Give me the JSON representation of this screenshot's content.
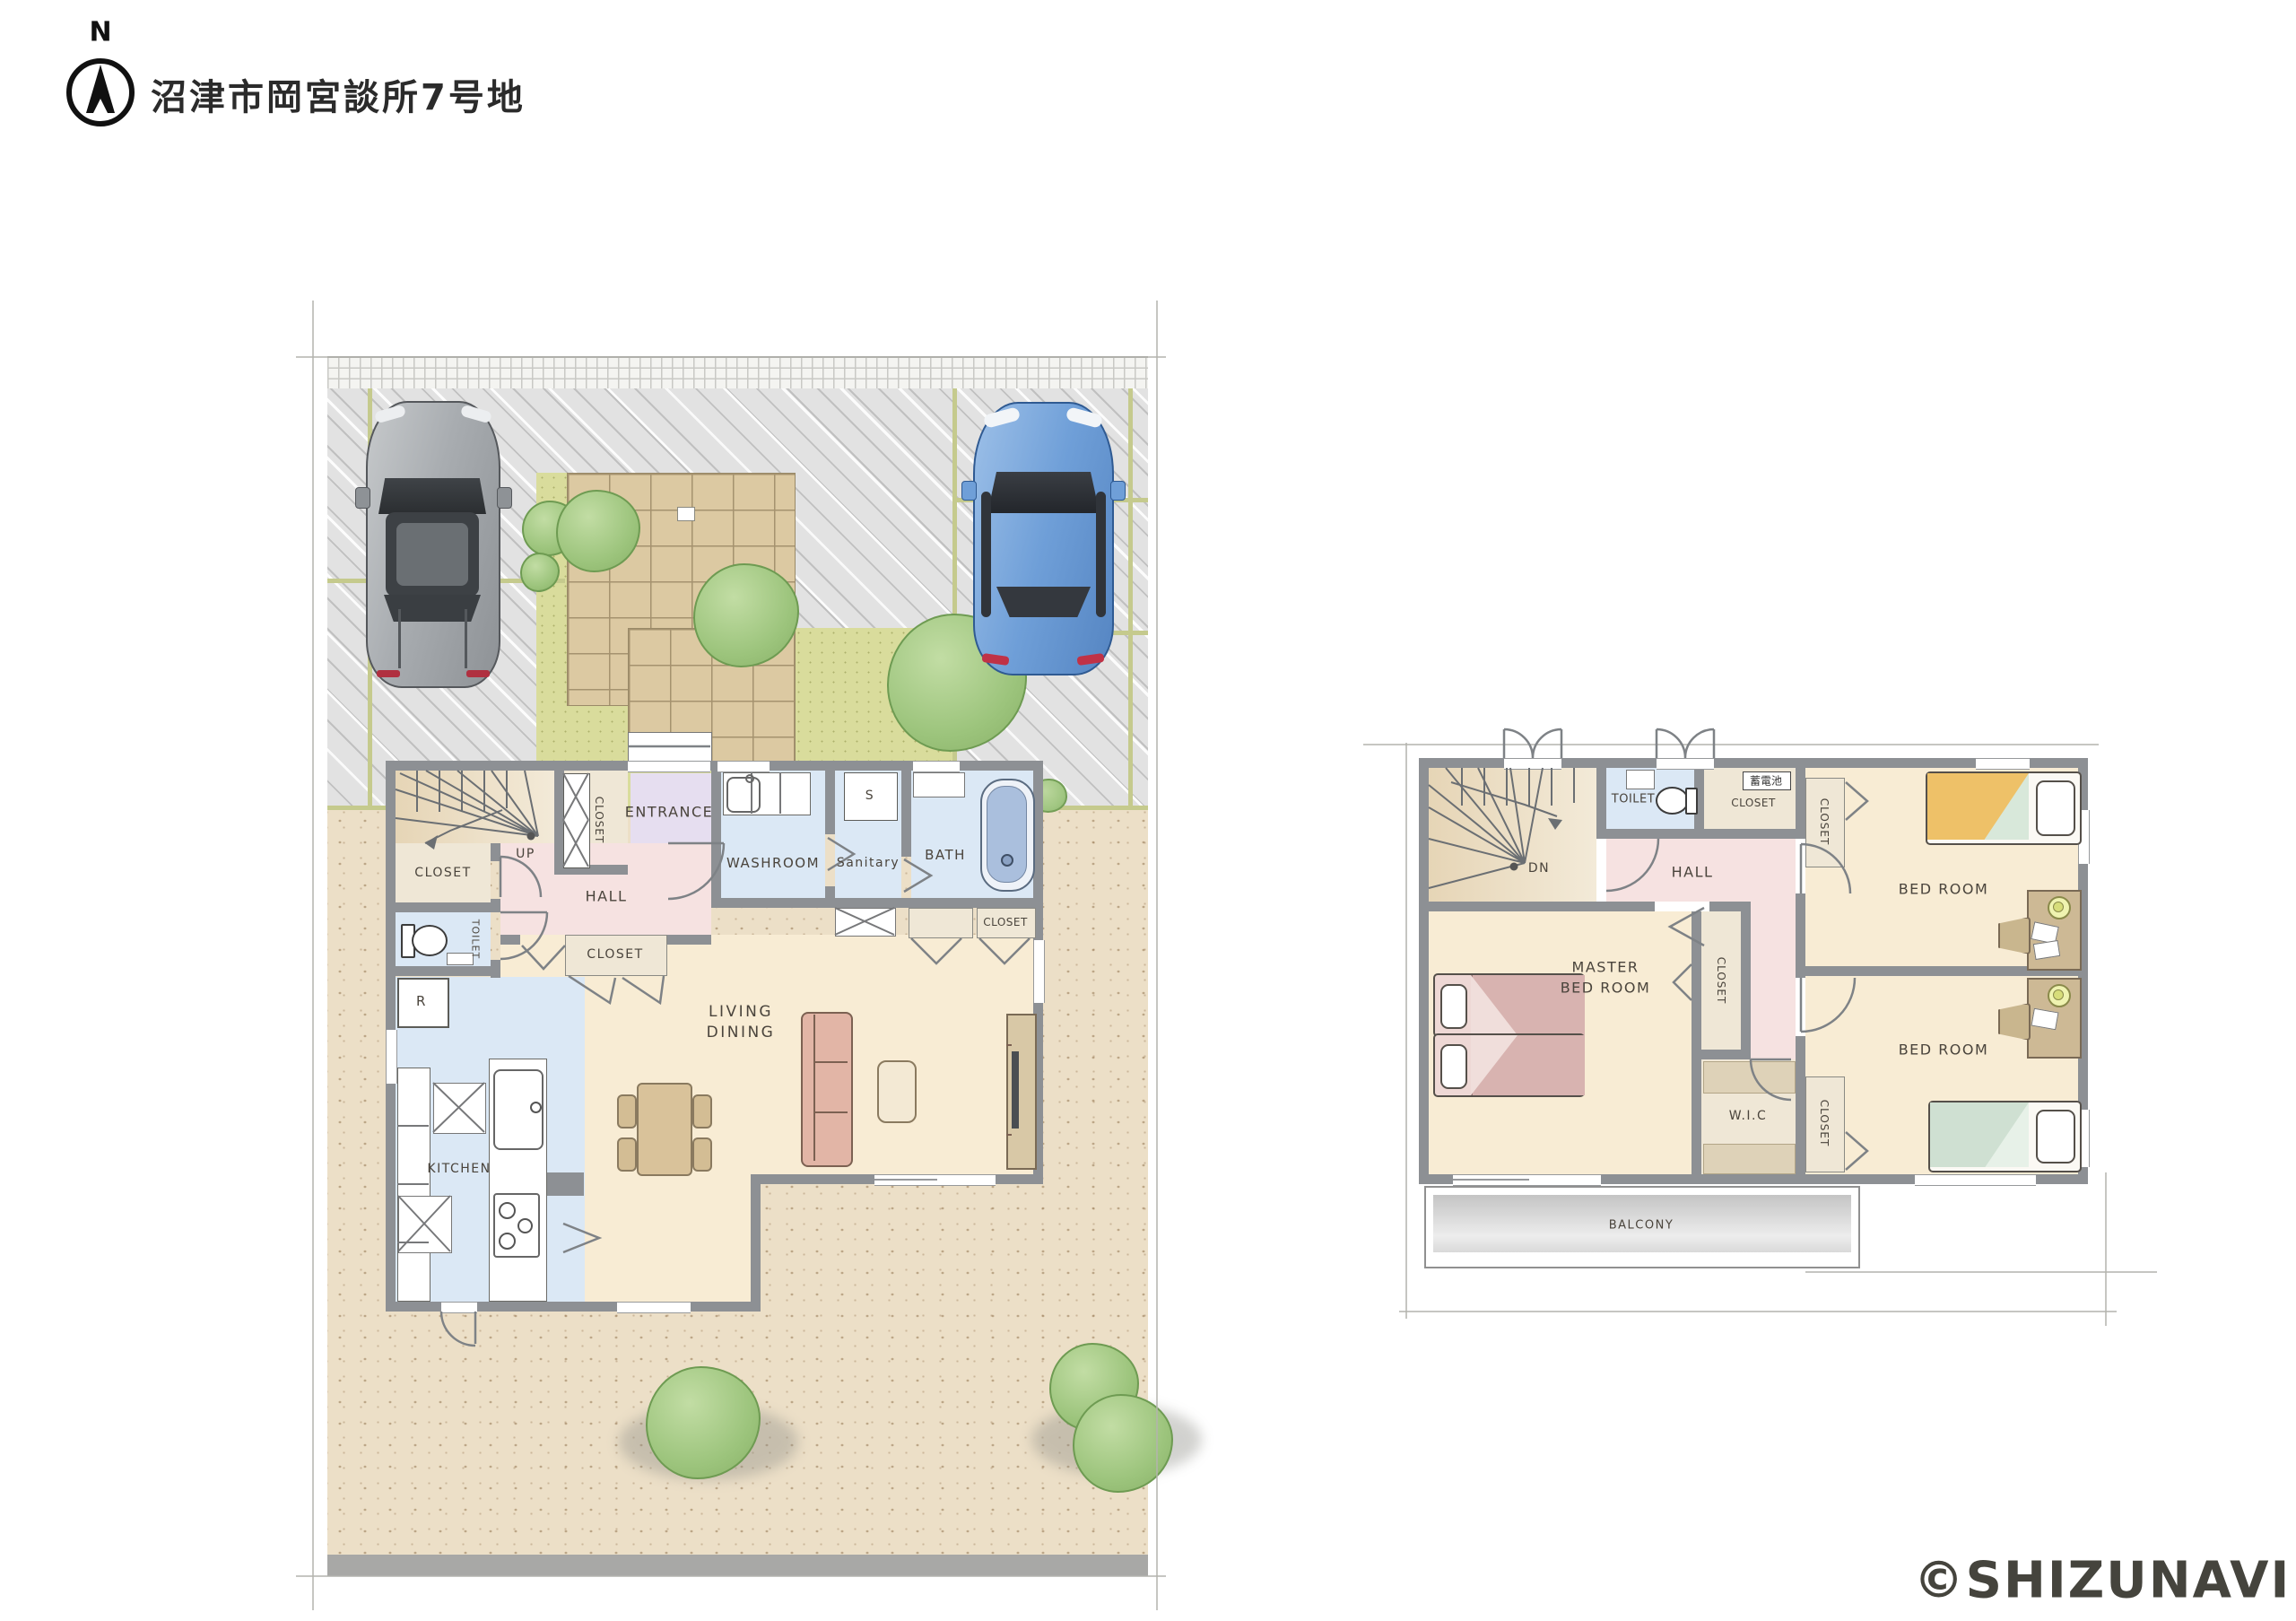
{
  "header": {
    "compass_n": "N",
    "title": "沼津市岡宮談所7号地"
  },
  "floor1": {
    "entrance": "ENTRANCE",
    "hall": "HALL",
    "up": "UP",
    "closet_understairs": "CLOSET",
    "closet_entry": "CLOSET",
    "closet_hall": "CLOSET",
    "closet_bathside": "CLOSET",
    "toilet": "TOILET",
    "refrigerator": "R",
    "washroom": "WASHROOM",
    "sanitary": "Sanitary",
    "shelf": "S",
    "bath": "BATH",
    "living_line1": "LIVING",
    "living_line2": "DINING",
    "kitchen": "KITCHEN"
  },
  "floor2": {
    "down": "DN",
    "toilet": "TOILET",
    "battery": "蓄電池",
    "closet_battery": "CLOSET",
    "hall": "HALL",
    "master_line1": "MASTER",
    "master_line2": "BED ROOM",
    "closet_master": "CLOSET",
    "bedroom_north": "BED ROOM",
    "bedroom_south": "BED ROOM",
    "closet_north": "CLOSET",
    "closet_south": "CLOSET",
    "wic": "W.I.C",
    "balcony": "BALCONY"
  },
  "watermark": "©SHIZUNAVI",
  "colors": {
    "wall": "#8d9094",
    "water_room": "#dbe8f5",
    "hall_pink": "#f6e2e1",
    "room_cream": "#f8ecd4",
    "entrance_purple": "#e6def0",
    "closet_beige": "#efe7d6",
    "site_sand": "#ecdfc7",
    "driveway": "#e2e2e2",
    "grass": "#d9dc9c",
    "stone_path": "#dcc9a2",
    "tree": "#9cc47c",
    "balcony_gray": "#cccccc",
    "bed_pink": "#ddb9b6",
    "bed_orange": "#eec168",
    "bed_green": "#cfe0d2",
    "car_gray": "#9aa0a4",
    "car_blue": "#6f9fd8"
  }
}
